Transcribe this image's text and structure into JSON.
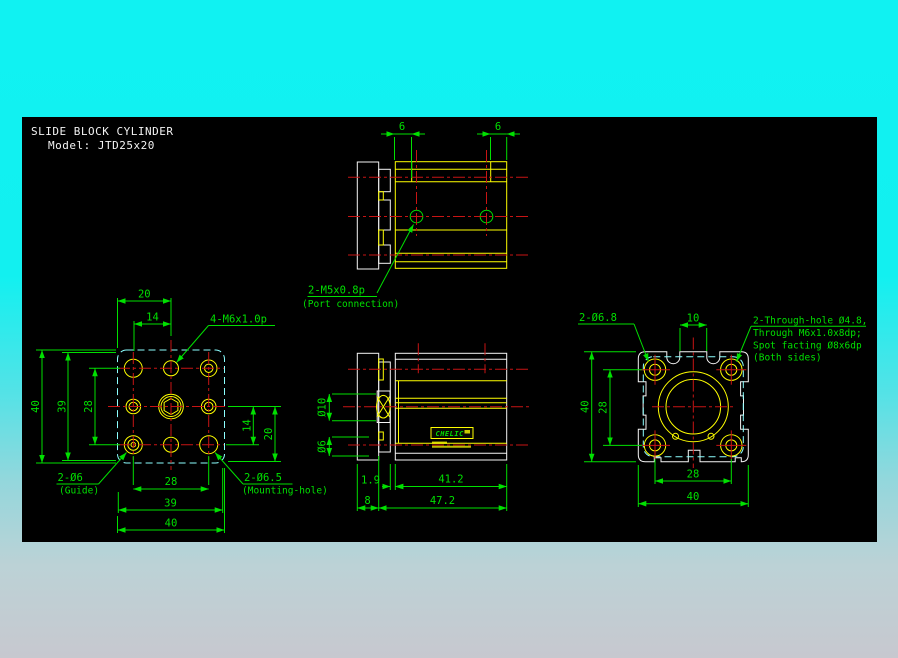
{
  "colors": {
    "background_top": "#10F2F2",
    "background_bottom": "#C7C8CF",
    "canvas": "#000000",
    "outline_white": "#F5F5F5",
    "body_yellow": "#FFFF00",
    "dimension_green": "#00E000",
    "centerline_red": "#C81414",
    "hidden_cyan": "#8CFFFF"
  },
  "title": {
    "line1": "SLIDE BLOCK CYLINDER",
    "line2": "Model: JTD25x20"
  },
  "top_view": {
    "dim_left": "6",
    "dim_right": "6",
    "port_label": "2-M5x0.8p",
    "port_note": "(Port connection)"
  },
  "plan_view": {
    "dim_top_20": "20",
    "dim_top_14": "14",
    "thread_label": "4-M6x1.0p",
    "dim_left_40": "40",
    "dim_left_39": "39",
    "dim_left_28": "28",
    "dim_right_14": "14",
    "dim_right_20": "20",
    "dim_bottom_28": "28",
    "dim_bottom_39": "39",
    "dim_bottom_40": "40",
    "guide_label": "2-Ø6",
    "guide_note": "(Guide)",
    "mount_label": "2-Ø6.5",
    "mount_note": "(Mounting-hole)"
  },
  "front_view": {
    "dim_rod": "Ø10",
    "dim_port": "Ø6",
    "dim_gap": "1.9",
    "dim_body": "41.2",
    "dim_flange": "8",
    "dim_total": "47.2",
    "brand": "CHELIC"
  },
  "side_view": {
    "dim_top_10": "10",
    "counterbore_label": "2-Ø6.8",
    "dim_left_40": "40",
    "dim_left_28": "28",
    "dim_bottom_28": "28",
    "dim_bottom_40": "40",
    "note_line1": "2-Through-hole Ø4.8,",
    "note_line2": "Through M6x1.0x8dp;",
    "note_line3": "Spot facting Ø8x6dp",
    "note_line4": "(Both sides)"
  }
}
